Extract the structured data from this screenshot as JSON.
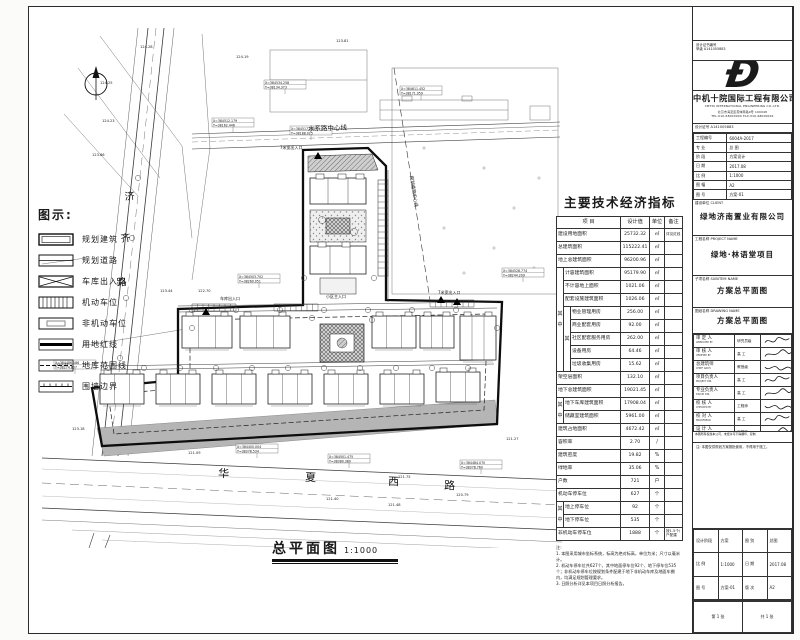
{
  "accent": {
    "ink": "#1a1a1a",
    "gray_fill": "#b5b5b5",
    "hatch": "#8e8e8e"
  },
  "legend": {
    "title": "图示:",
    "items": [
      {
        "name": "planned-building",
        "swatch": "double-rect",
        "label": "规划建筑"
      },
      {
        "name": "planned-road",
        "swatch": "road",
        "label": "规划道路"
      },
      {
        "name": "garage-entrance",
        "swatch": "garage",
        "label": "车库出入口"
      },
      {
        "name": "car-parking",
        "swatch": "comb",
        "label": "机动车位"
      },
      {
        "name": "bike-parking",
        "swatch": "inner-gray",
        "label": "非机动车位"
      },
      {
        "name": "land-red-line",
        "swatch": "bold-line",
        "label": "用地红线"
      },
      {
        "name": "basement-line",
        "swatch": "dash-line",
        "label": "地库范围线"
      },
      {
        "name": "wall-boundary",
        "swatch": "wall",
        "label": "围墙边界"
      }
    ]
  },
  "plan": {
    "title": "总平面图",
    "scale": "1:1000",
    "labels": [
      {
        "t": "水系路中心线",
        "x": 266,
        "y": 103,
        "s": 6.5,
        "r": -2
      },
      {
        "t": "7米宽出入口",
        "x": 238,
        "y": 121,
        "s": 4,
        "r": 0
      },
      {
        "t": "规划道路中心线",
        "x": 368,
        "y": 148,
        "s": 4.5,
        "r": 81
      },
      {
        "t": "小区主入口",
        "x": 284,
        "y": 270,
        "s": 4,
        "r": 0
      },
      {
        "t": "车库出入口",
        "x": 178,
        "y": 272,
        "s": 4,
        "r": 0
      },
      {
        "t": "7米宽出入口",
        "x": 396,
        "y": 266,
        "s": 4,
        "r": 0
      },
      {
        "t": "济",
        "x": 83,
        "y": 172,
        "s": 10,
        "r": -6
      },
      {
        "t": "齐",
        "x": 79,
        "y": 214,
        "s": 10,
        "r": -6
      },
      {
        "t": "路",
        "x": 75,
        "y": 258,
        "s": 10,
        "r": -6
      },
      {
        "t": "华",
        "x": 176,
        "y": 449,
        "s": 11,
        "r": 2
      },
      {
        "t": "夏",
        "x": 263,
        "y": 453,
        "s": 11,
        "r": 2
      },
      {
        "t": "西",
        "x": 346,
        "y": 457,
        "s": 11,
        "r": 2
      },
      {
        "t": "路",
        "x": 402,
        "y": 461,
        "s": 11,
        "r": 2
      }
    ],
    "coords": [
      {
        "x": 222,
        "y": 52,
        "a": "X=384534.258",
        "b": "Y=38134.373"
      },
      {
        "x": 170,
        "y": 90,
        "a": "X=384512.179",
        "b": "Y=38162.446"
      },
      {
        "x": 358,
        "y": 58,
        "a": "X=384611.452",
        "b": "Y=38171.059"
      },
      {
        "x": 248,
        "y": 98,
        "a": "X=384517.275",
        "b": "Y=38188.025"
      },
      {
        "x": 196,
        "y": 246,
        "a": "X=384503.702",
        "b": "Y=38260.051"
      },
      {
        "x": 460,
        "y": 240,
        "a": "X=384528.774",
        "b": "Y=38244.209"
      },
      {
        "x": 12,
        "y": 332,
        "a": "X=384486.186",
        "b": "Y=38274.807"
      },
      {
        "x": 194,
        "y": 416,
        "a": "X=384400.004",
        "b": "Y=38378.534"
      },
      {
        "x": 286,
        "y": 426,
        "a": "X=384501.475",
        "b": "Y=38380.380"
      },
      {
        "x": 418,
        "y": 432,
        "a": "X=384484.070",
        "b": "Y=38378.760"
      }
    ],
    "elevations": [
      {
        "x": 58,
        "y": 56,
        "t": "124.25"
      },
      {
        "x": 60,
        "y": 94,
        "t": "124.23"
      },
      {
        "x": 50,
        "y": 128,
        "t": "123.86"
      },
      {
        "x": 118,
        "y": 264,
        "t": "123.44"
      },
      {
        "x": 156,
        "y": 264,
        "t": "122.70"
      },
      {
        "x": 14,
        "y": 338,
        "t": "122.77"
      },
      {
        "x": 30,
        "y": 402,
        "t": "123.18"
      },
      {
        "x": 146,
        "y": 426,
        "t": "121.09"
      },
      {
        "x": 284,
        "y": 472,
        "t": "121.40"
      },
      {
        "x": 346,
        "y": 478,
        "t": "121.48"
      },
      {
        "x": 414,
        "y": 468,
        "t": "120.79"
      },
      {
        "x": 464,
        "y": 412,
        "t": "121.27"
      },
      {
        "x": 194,
        "y": 30,
        "t": "124.19"
      },
      {
        "x": 294,
        "y": 14,
        "t": "123.81"
      },
      {
        "x": 356,
        "y": 450,
        "t": "121.75"
      },
      {
        "x": 98,
        "y": 20,
        "t": "124.28"
      }
    ]
  },
  "table": {
    "title": "主要技术经济指标",
    "headers": [
      "项  目",
      "设计值",
      "单位",
      "备注"
    ],
    "rows": [
      {
        "label": "建设用地面积",
        "value": "25732.32",
        "unit": "㎡",
        "note": "详见红线"
      },
      {
        "label": "总建筑面积",
        "value": "115222.41",
        "unit": "㎡",
        "note": ""
      },
      {
        "label": "地上总建筑面积",
        "value": "96200.96",
        "unit": "㎡",
        "note": ""
      },
      {
        "g1": {
          "t": "其中",
          "span": 8
        },
        "label": "计容建筑面积",
        "value": "95179.90",
        "unit": "㎡",
        "note": ""
      },
      {
        "g1": true,
        "label": "不计容地上面积",
        "value": "1021.06",
        "unit": "㎡",
        "note": ""
      },
      {
        "g1": true,
        "label": "配套设施建筑面积",
        "value": "1026.06",
        "unit": "㎡",
        "note": ""
      },
      {
        "g1": true,
        "g2": {
          "t": "其",
          "span": 5
        },
        "label": "物业管理用房",
        "value": "256.00",
        "unit": "㎡",
        "note": ""
      },
      {
        "g1": true,
        "g2": true,
        "label": "商业配套用房",
        "value": "92.00",
        "unit": "㎡",
        "note": ""
      },
      {
        "g1": true,
        "g2": true,
        "label": "社区配套服务用房",
        "value": "262.00",
        "unit": "㎡",
        "note": ""
      },
      {
        "g1": true,
        "g2": true,
        "label": "设备用房",
        "value": "64.46",
        "unit": "㎡",
        "note": ""
      },
      {
        "g1": true,
        "g2": true,
        "label": "垃圾收集用房",
        "value": "15.62",
        "unit": "㎡",
        "note": ""
      },
      {
        "label": "架空层面积",
        "value": "132.10",
        "unit": "㎡",
        "note": ""
      },
      {
        "label": "地下总建筑面积",
        "value": "19021.45",
        "unit": "㎡",
        "note": ""
      },
      {
        "g1": {
          "t": "其中",
          "span": 2
        },
        "label": "地下车库建筑面积",
        "value": "17908.04",
        "unit": "㎡",
        "note": ""
      },
      {
        "g1": true,
        "label": "储藏室建筑面积",
        "value": "5961.00",
        "unit": "㎡",
        "note": ""
      },
      {
        "label": "建筑占地面积",
        "value": "4672.42",
        "unit": "㎡",
        "note": ""
      },
      {
        "label": "容积率",
        "value": "2.70",
        "unit": "/",
        "note": ""
      },
      {
        "label": "建筑密度",
        "value": "19.82",
        "unit": "%",
        "note": ""
      },
      {
        "label": "绿地率",
        "value": "35.06",
        "unit": "%",
        "note": ""
      },
      {
        "label": "户数",
        "value": "721",
        "unit": "户",
        "note": ""
      },
      {
        "label": "机动车停车位",
        "value": "627",
        "unit": "个",
        "note": ""
      },
      {
        "g1": {
          "t": "其中",
          "span": 2
        },
        "label": "地上停车位",
        "value": "92",
        "unit": "个",
        "note": ""
      },
      {
        "g1": true,
        "label": "地下停车位",
        "value": "535",
        "unit": "个",
        "note": ""
      },
      {
        "label": "非机动车停车位",
        "value": "1888",
        "unit": "个",
        "note": "按1.5个/户配建"
      }
    ],
    "notes_title": "注:",
    "notes": [
      "1. 本图采用城市坐标系统，标高为绝对标高，单位为米；尺寸以毫米计。",
      "2. 机动车停车位共627个，其中地面停车位92个、地下停车位535个；非机动车停车位按规划条件配建于地下非机动车库及地面车棚内，均满足规划管理要求。",
      "3. 日照分析详见本项目日照分析报告。"
    ]
  },
  "titleblock": {
    "cert_line1": "设计证书编号",
    "cert_line2": "甲级 A141005883",
    "logo_glyph": "Ð",
    "company": "中机十院国际工程有限公司",
    "company_en": "CMTDI INTERNATIONAL ENGINEERING CO.,LTD.",
    "address1": "北京市海淀区首体南路9号 100048",
    "address2": "TEL:010-68000000  FAX:010-68000001",
    "info_header": "设计证号 A141005883",
    "info_rows": [
      [
        "工程编号",
        "6004A-2017"
      ],
      [
        "专  业",
        "总  图"
      ],
      [
        "阶  段",
        "方案设计"
      ],
      [
        "日  期",
        "2017.08"
      ],
      [
        "比  例",
        "1:1000"
      ],
      [
        "图  幅",
        "A2"
      ],
      [
        "图  号",
        "方案-01"
      ]
    ],
    "client_label": "建设单位 CLIENT",
    "client": "绿地济南置业有限公司",
    "project_label": "工程名称 PROJECT NAME",
    "project": "绿地·林语堂项目",
    "subitem_label": "子项名称 SUBITEM NAME",
    "subitem": "方案总平面图",
    "drawing_label": "图纸名称 DRAWING NAME",
    "drawing": "方案总平面图",
    "sign_rows": [
      {
        "cn": "审 定 人",
        "en": "APPROVED BY",
        "mid": "研究员级"
      },
      {
        "cn": "审 核 人",
        "en": "VERIFIED BY",
        "mid": "高  工"
      },
      {
        "cn": "总建筑师",
        "en": "CHIEF ARCH.",
        "mid": "教授级"
      },
      {
        "cn": "项目负责人",
        "en": "PROJECT DIR.",
        "mid": "高  工"
      },
      {
        "cn": "专业负责人",
        "en": "DISCIP. DIR.",
        "mid": "高  工"
      },
      {
        "cn": "校 核 人",
        "en": "CHECKED BY",
        "mid": "工程师"
      },
      {
        "cn": "校 对 人",
        "en": "PROOFREAD",
        "mid": "高  工"
      },
      {
        "cn": "设 计 人",
        "en": "DESIGNED BY",
        "mid": "工程师"
      }
    ],
    "copyright": "本图所有权属本公司，未经许可不得翻印、复制",
    "remark": "注: 本图仅供规划方案报批使用，不得用于施工。",
    "mini_rows": [
      [
        [
          "设计阶段",
          "方案"
        ],
        [
          "图  别",
          "总图"
        ]
      ],
      [
        [
          "比  例",
          "1:1000"
        ],
        [
          "日  期",
          "2017.08"
        ]
      ],
      [
        [
          "图  号",
          "方案-01"
        ],
        [
          "版  次",
          "A2"
        ]
      ]
    ],
    "last_row": [
      "第 1 张",
      "共 1 张"
    ]
  }
}
